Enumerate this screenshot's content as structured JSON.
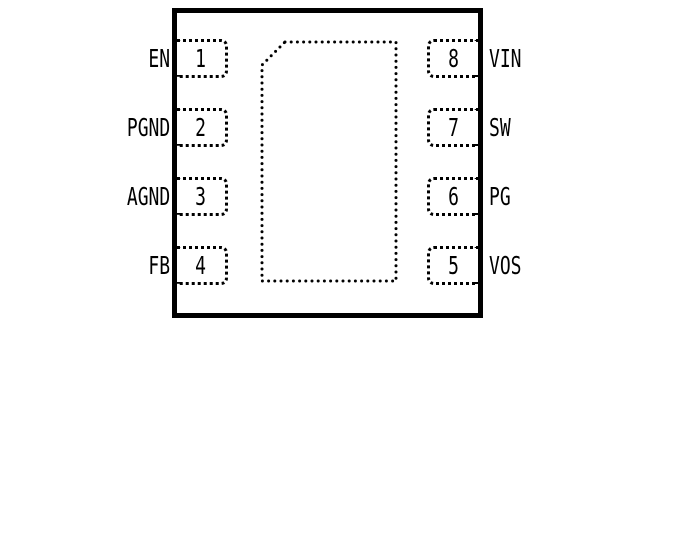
{
  "diagram": {
    "kind": "ic-package-pinout",
    "colors": {
      "line": "#000000",
      "background": "#ffffff"
    },
    "pins_left": [
      {
        "number": "1",
        "label": "EN"
      },
      {
        "number": "2",
        "label": "PGND"
      },
      {
        "number": "3",
        "label": "AGND"
      },
      {
        "number": "4",
        "label": "FB"
      }
    ],
    "pins_right": [
      {
        "number": "8",
        "label": "VIN"
      },
      {
        "number": "7",
        "label": "SW"
      },
      {
        "number": "6",
        "label": "PG"
      },
      {
        "number": "5",
        "label": "VOS"
      }
    ]
  }
}
